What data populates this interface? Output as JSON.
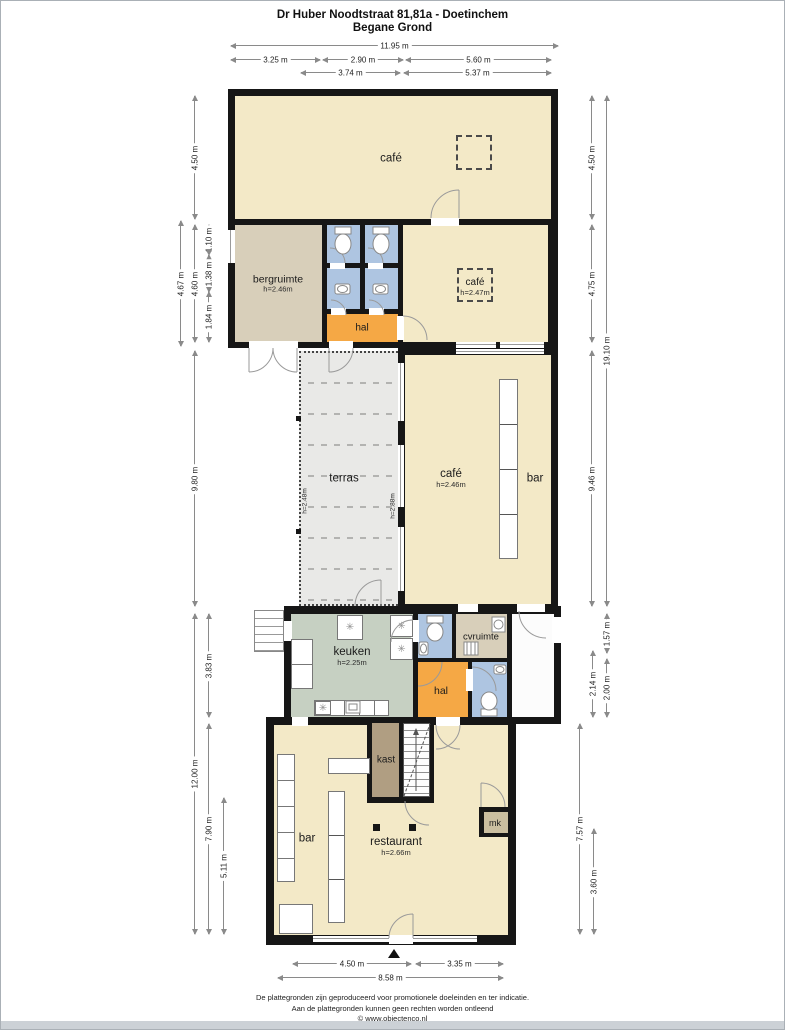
{
  "page": {
    "title": "Dr Huber Noodtstraat 81,81a - Doetinchem",
    "subtitle": "Begane Grond"
  },
  "footer": {
    "line1": "De plattegronden zijn geproduceerd voor promotionele doeleinden en ter indicatie.",
    "line2": "Aan de plattegronden kunnen geen rechten worden ontleend",
    "line3": "© www.objectenco.nl"
  },
  "rooms": {
    "cafe_top": {
      "label": "café"
    },
    "bergruimte": {
      "label": "bergruimte",
      "height": "h=2.46m"
    },
    "hal_top": {
      "label": "hal"
    },
    "cafe_mid": {
      "label": "café",
      "height": "h=2.47m"
    },
    "terras": {
      "label": "terras",
      "height_left": "h=2.48m",
      "height_right": "h=2.88m"
    },
    "cafe_bar": {
      "label": "café",
      "height": "h=2.46m",
      "bar_label": "bar"
    },
    "keuken": {
      "label": "keuken",
      "height": "h=2.25m"
    },
    "cvruimte": {
      "label": "cvruimte"
    },
    "hal_lower": {
      "label": "hal"
    },
    "kast": {
      "label": "kast"
    },
    "restaurant": {
      "label": "restaurant",
      "height": "h=2.66m",
      "bar_label": "bar"
    },
    "mk": {
      "label": "mk"
    }
  },
  "dimensions": {
    "top": [
      "11.95 m",
      "3.25 m",
      "2.90 m",
      "5.60 m",
      "3.74 m",
      "5.37 m"
    ],
    "bottom": [
      "4.50 m",
      "3.35 m",
      "8.58 m"
    ],
    "left": [
      "4.50 m",
      "4.67 m",
      "4.60 m",
      "1.10 m",
      "1.38 m",
      "1.84 m",
      "9.80 m",
      "3.83 m",
      "12.00 m",
      "7.90 m",
      "5.11 m"
    ],
    "right": [
      "4.50 m",
      "19.10 m",
      "4.75 m",
      "9.46 m",
      "1.57 m",
      "2.14 m",
      "2.00 m",
      "7.57 m",
      "3.60 m"
    ]
  },
  "colors": {
    "wall": "#161616",
    "floor_cream": "#f3e9c7",
    "floor_tan": "#d8cfba",
    "floor_blue": "#aec5e1",
    "floor_orange": "#f5a845",
    "floor_sage": "#c6d0c2",
    "floor_grey": "#e9e9e7",
    "floor_brown": "#b09e82",
    "floor_mk": "#cbbfa0"
  }
}
